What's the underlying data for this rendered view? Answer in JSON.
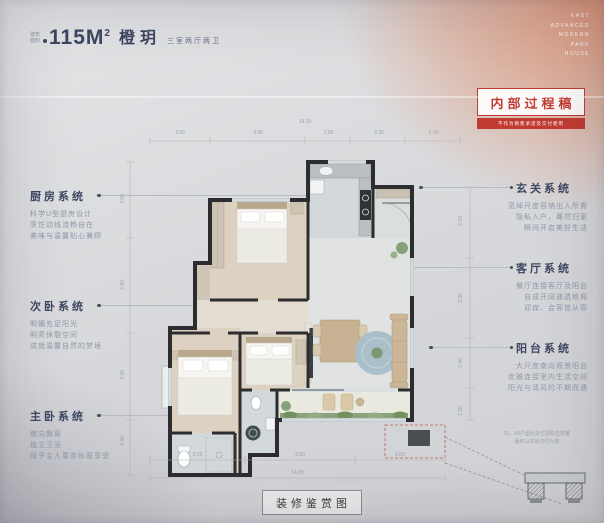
{
  "header": {
    "area_prefix_line1": "建筑",
    "area_prefix_line2": "面积",
    "area_value": "115M",
    "area_sup": "2",
    "project_name": "橙玥",
    "layout_desc": "三室两厅两卫"
  },
  "corner_brand": {
    "line1": "EAST",
    "line2": "ADVANCED",
    "line3": "MODERN",
    "line4": "PARK",
    "line5": "HOUSE"
  },
  "stamp": {
    "title": "内部过程稿",
    "disclaimer": "不作为销售承诺及交付使用"
  },
  "left_annotations": [
    {
      "title": "厨房系统",
      "lines": [
        "科学U型厨房设计",
        "烹饪动线流畅自在",
        "美味与温馨贴心兼顾"
      ]
    },
    {
      "title": "次卧系统",
      "lines": [
        "明媚充足阳光",
        "明亮休憩空间",
        "成就温馨自然的梦境"
      ]
    },
    {
      "title": "主卧系统",
      "lines": [
        "南向飘窗",
        "独立卫浴",
        "赋予主人尊崇私密享受"
      ]
    }
  ],
  "right_annotations": [
    {
      "title": "玄关系统",
      "lines": [
        "宽绰尺度容纳出入所需",
        "隐私入户，蓦然归家",
        "瞬间开启美好生活"
      ]
    },
    {
      "title": "客厅系统",
      "lines": [
        "餐厅连接客厅及阳台",
        "自成开阔通透格局",
        "迎宾、会客皆从容"
      ]
    },
    {
      "title": "阳台系统",
      "lines": [
        "大尺度南向观景阳台",
        "优雅连接室内生活空间",
        "阳光与清风的不期而遇"
      ]
    }
  ],
  "floorplan": {
    "dims": {
      "top_total": "14.15",
      "top": [
        "3.05",
        "3.60",
        "1.50",
        "3.30",
        "2.70"
      ],
      "bottom": [
        "3.05",
        "3.90",
        "2.60"
      ],
      "bottom_total": "14.15",
      "left": [
        "3.00",
        "2.90",
        "3.30",
        "2.40"
      ],
      "right": [
        "2.60",
        "3.30",
        "2.40",
        "1.20"
      ]
    },
    "detail_note_line1": "01、04户型此处空调机位布置",
    "detail_note_line2": "最终以实际交付为准"
  },
  "footer": {
    "label": "装修鉴赏图"
  },
  "colors": {
    "accent_navy": "#3d4763",
    "stamp_red": "#c13b33",
    "desc_gray": "#9097a8"
  }
}
